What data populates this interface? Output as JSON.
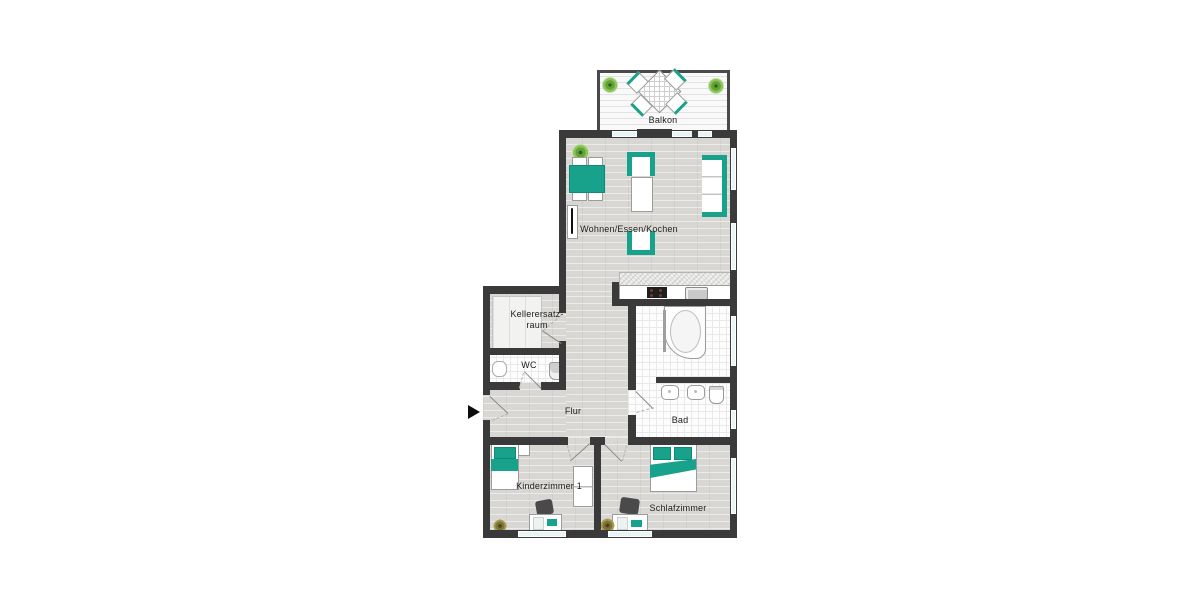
{
  "colors": {
    "wall": "#3a3a3a",
    "accent_teal": "#18a28c",
    "floor_wood": "#d8d7d3",
    "floor_tile": "#fdfdfd",
    "window_glass": "#e9f4f5",
    "label_text": "#1c1c1c"
  },
  "rooms": {
    "balkon": {
      "label": "Balkon",
      "furniture": [
        "table",
        "4 chairs",
        "2 plants"
      ]
    },
    "wohnen": {
      "label": "Wohnen/Essen/Kochen",
      "furniture": [
        "dining table",
        "4 chairs",
        "plant",
        "radiator",
        "2 armchairs",
        "coffee table",
        "sofa",
        "kitchen counter",
        "stove",
        "sink"
      ]
    },
    "kellerersatzraum": {
      "label_line1": "Kellerersatz-",
      "label_line2": "raum",
      "furniture": [
        "shelf"
      ]
    },
    "wc": {
      "label": "WC",
      "furniture": [
        "wash basin",
        "toilet"
      ]
    },
    "flur": {
      "label": "Flur",
      "furniture": []
    },
    "bad": {
      "label": "Bad",
      "furniture": [
        "corner bathtub",
        "vanity with 2 basins",
        "toilet"
      ]
    },
    "kinderzimmer": {
      "label": "Kinderzimmer 1",
      "furniture": [
        "single bed",
        "nightstand",
        "wardrobe",
        "desk",
        "chair",
        "plant"
      ]
    },
    "schlafzimmer": {
      "label": "Schlafzimmer",
      "furniture": [
        "double bed",
        "desk",
        "chair",
        "plant"
      ]
    }
  },
  "entrance": {
    "marker": "arrow pointing right into Flur"
  }
}
